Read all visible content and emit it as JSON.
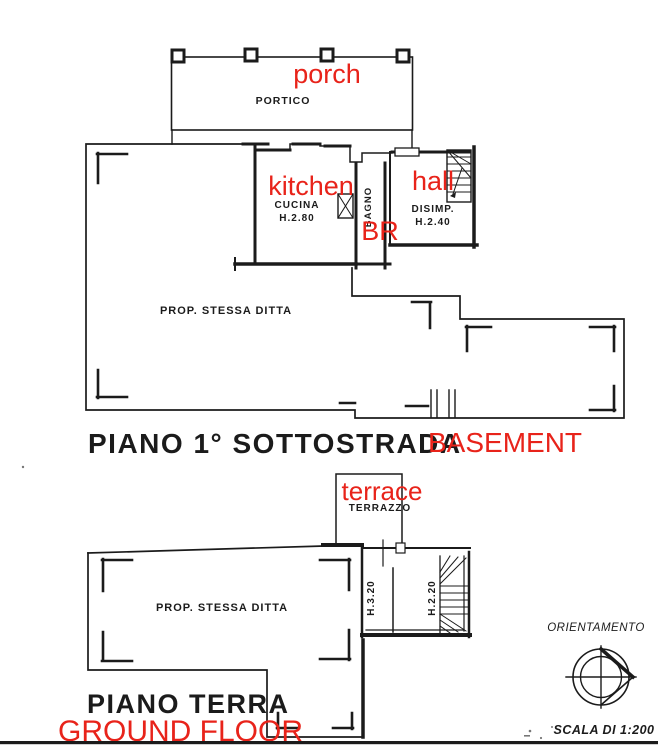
{
  "plans": {
    "basement": {
      "porch": {
        "it": "PORTICO",
        "en": "porch"
      },
      "kitchen": {
        "it": "CUCINA",
        "height": "H.2.80",
        "en": "kitchen"
      },
      "bath": {
        "it": "BAGNO",
        "en": "BR"
      },
      "hall": {
        "it": "DISIMP.",
        "height": "H.2.40",
        "en": "hall"
      },
      "property": "PROP.  STESSA DITTA",
      "title": {
        "it": "PIANO 1° SOTTOSTRADA",
        "en": "BASEMENT"
      }
    },
    "ground": {
      "terrace": {
        "it": "TERRAZZO",
        "en": "terrace"
      },
      "property": "PROP. STESSA DITTA",
      "rooms": {
        "left_height": "H.3.20",
        "right_height": "H.2.20"
      },
      "title": {
        "it": "PIANO TERRA",
        "en": "GROUND FLOOR"
      }
    }
  },
  "legend": {
    "orientation": "ORIENTAMENTO",
    "scale": "SCALA DI 1:200"
  },
  "colors": {
    "ink": "#1b1b1b",
    "annotation_red": "#e8231a",
    "paper": "#ffffff"
  }
}
